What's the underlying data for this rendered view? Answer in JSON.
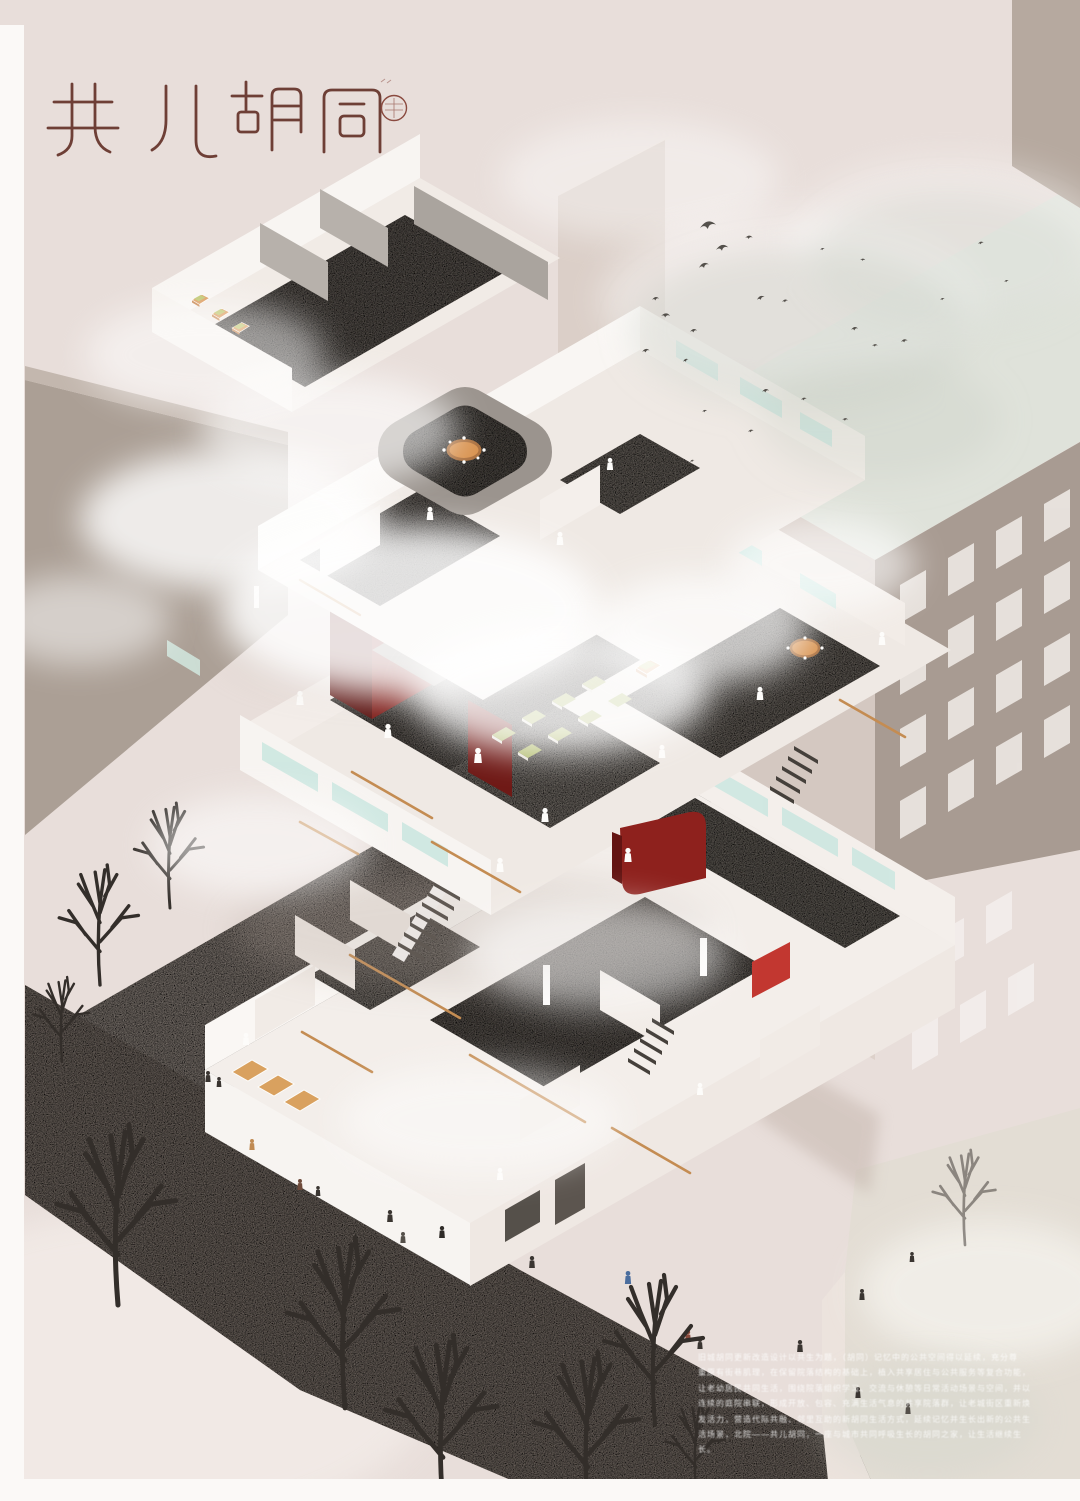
{
  "poster": {
    "title": {
      "text": "共儿胡同",
      "characters": [
        "共",
        "儿",
        "胡",
        "同"
      ],
      "seal": "circular-seal-stamp"
    },
    "caption": {
      "lines": [
        "旧城胡同更新改造设计以共生为题，（胡同）记忆中的公共空间得以延续，充分尊",
        "重原有街巷肌理，在保留院落结构的基础上，植入共享居住与公共服务等复合功能，",
        "让老幼居民共同生活，围绕院落组织学习、交流与休憩等日常活动场景与空间，并以",
        "连续的庭院串联，形成开放、包容、充满生活气息的共享院落群，让老城街区重新焕",
        "发活力，营造代际共融、邻里互助的新胡同生活方式，延续记忆并生长出新的公共生",
        "活场景，北院——共儿胡同，一座与城市共同呼吸生长的胡同之家，让生活继续生",
        "长。"
      ]
    },
    "palette": {
      "background": "#e8deda",
      "accent_maroon": "#7f1e1a",
      "accent_bright_red": "#c23730",
      "mint_window": "#cde7e1",
      "wood_handrail": "#c48c52",
      "green_furniture": "#a9b45f",
      "orange_furniture": "#d8924f",
      "road_grey": "#8a7f77",
      "wall_white": "#f7f4f1",
      "neighbor_taupe": "#a89b92",
      "title_ink": "#643229"
    }
  }
}
